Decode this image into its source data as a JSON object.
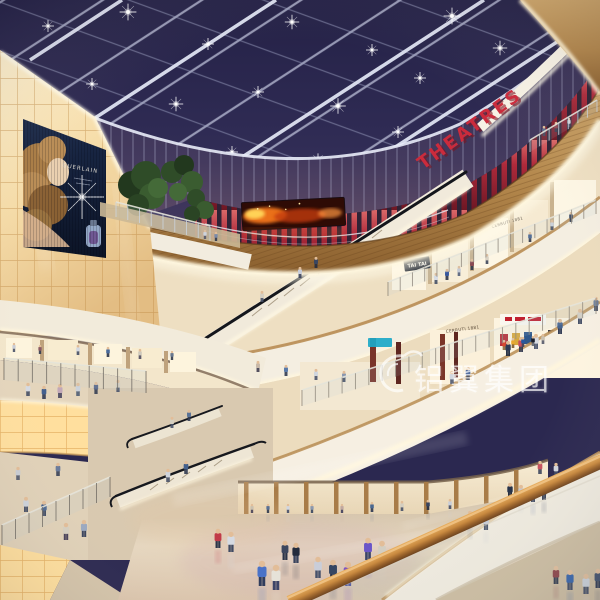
{
  "meta": {
    "description": "Architectural rendering of a multi-level shopping mall atrium at night with glass skylight"
  },
  "signs": {
    "theatres": "THEATRES",
    "cerruti_upper": "CERRUTI 1881",
    "cerruti_lower": "CERRUTI 1881",
    "tai_tai": "TAI TAI"
  },
  "billboard": {
    "brand": "GUERLAIN"
  },
  "watermark": {
    "text": "铝翼集团"
  },
  "palette": {
    "sky": "#2b2850",
    "sky_deep": "#1d1b3a",
    "beam": "#dfe3f2",
    "wood": "#b9894e",
    "wood_dark": "#8a5f2e",
    "fascia_white": "#f4ede0",
    "cove_glow": "#fff4d6",
    "sign_red": "#cb2b3c",
    "slat_red": "#a8293a",
    "wall_glow": "#f6dca8",
    "screen_fire": "#ff7b1e",
    "billboard_navy": "#16223e",
    "floor": "#d9c9b2",
    "rail_wood": "#c08547",
    "watermark_white": "#ffffff"
  },
  "scene": {
    "stars": [
      [
        48,
        26,
        1
      ],
      [
        128,
        12,
        1.4
      ],
      [
        208,
        44,
        1
      ],
      [
        292,
        22,
        1.2
      ],
      [
        372,
        50,
        1
      ],
      [
        452,
        16,
        1.4
      ],
      [
        540,
        10,
        1
      ],
      [
        92,
        84,
        1
      ],
      [
        176,
        104,
        1.2
      ],
      [
        258,
        92,
        1
      ],
      [
        338,
        106,
        1.3
      ],
      [
        420,
        78,
        1
      ],
      [
        500,
        48,
        1.2
      ],
      [
        146,
        148,
        0.9
      ],
      [
        232,
        152,
        1
      ],
      [
        318,
        160,
        1.1
      ],
      [
        398,
        132,
        1
      ],
      [
        64,
        142,
        0.9
      ],
      [
        560,
        96,
        1
      ],
      [
        582,
        60,
        1
      ]
    ],
    "people": [
      [
        544,
        136,
        10,
        "#5c6c8c",
        "#3a4258"
      ],
      [
        556,
        132,
        10,
        "#8c3c44",
        "#2e3448"
      ],
      [
        569,
        127,
        9,
        "#d8d8dc",
        "#4a5068"
      ],
      [
        300,
        278,
        11,
        "#c9cdd9",
        "#38415c"
      ],
      [
        316,
        268,
        11,
        "#3a4660",
        "#242c40"
      ],
      [
        262,
        302,
        11,
        "#d6d0c2",
        "#454f67"
      ],
      [
        205,
        239,
        9,
        "#d0d4dc",
        "#4a4a5a"
      ],
      [
        216,
        241,
        9,
        "#7a8aa8",
        "#323a4e"
      ],
      [
        436,
        284,
        11,
        "#d8dce4",
        "#434e66"
      ],
      [
        447,
        280,
        11,
        "#39589c",
        "#2a3146"
      ],
      [
        459,
        276,
        10,
        "#c5cad4",
        "#55607a"
      ],
      [
        472,
        270,
        11,
        "#8a4a52",
        "#2e3446"
      ],
      [
        487,
        264,
        10,
        "#d9d2c4",
        "#3c4458"
      ],
      [
        530,
        242,
        10,
        "#47628e",
        "#2c3246"
      ],
      [
        552,
        230,
        10,
        "#cdd2da",
        "#3e4a62"
      ],
      [
        571,
        222,
        10,
        "#32405c",
        "#232c40"
      ],
      [
        14,
        352,
        9,
        "#c8ccd6",
        "#4a5268"
      ],
      [
        40,
        354,
        9,
        "#8a5a62",
        "#343c50"
      ],
      [
        78,
        355,
        10,
        "#d4d8e0",
        "#444e66"
      ],
      [
        108,
        357,
        10,
        "#4a6a9a",
        "#2c3448"
      ],
      [
        140,
        359,
        10,
        "#cfc9bc",
        "#4e4a5e"
      ],
      [
        172,
        360,
        9,
        "#68788f",
        "#303a4e"
      ],
      [
        28,
        396,
        13,
        "#d6dae2",
        "#3e4860"
      ],
      [
        44,
        399,
        13,
        "#44608e",
        "#2c3650"
      ],
      [
        60,
        398,
        14,
        "#c2a8b8",
        "#42405a"
      ],
      [
        78,
        396,
        13,
        "#ccd2da",
        "#4a5a72"
      ],
      [
        96,
        394,
        12,
        "#5a6888",
        "#323c52"
      ],
      [
        118,
        392,
        12,
        "#d8d0c0",
        "#46506a"
      ],
      [
        258,
        372,
        11,
        "#c8b8a8",
        "#403c50"
      ],
      [
        286,
        376,
        11,
        "#5878a8",
        "#2e3850"
      ],
      [
        316,
        380,
        11,
        "#d0d6de",
        "#48526c"
      ],
      [
        344,
        382,
        11,
        "#8a98b0",
        "#3a445c"
      ],
      [
        452,
        384,
        13,
        "#d2d7df",
        "#454f69"
      ],
      [
        468,
        380,
        13,
        "#3c5a92",
        "#2b3348"
      ],
      [
        508,
        356,
        15,
        "#2e3a54",
        "#202a3e"
      ],
      [
        521,
        352,
        15,
        "#c74f5c",
        "#323a50"
      ],
      [
        536,
        349,
        15,
        "#d8dbe2",
        "#4a546e"
      ],
      [
        560,
        334,
        15,
        "#46648f",
        "#2d3650"
      ],
      [
        580,
        324,
        15,
        "#d5cfc2",
        "#3f4962"
      ],
      [
        596,
        311,
        14,
        "#6a7a96",
        "#333d55"
      ],
      [
        504,
        350,
        10,
        "#d84a30",
        "#8a6a3a"
      ],
      [
        513,
        348,
        10,
        "#e8a830",
        "#7a5a30"
      ],
      [
        523,
        347,
        10,
        "#2858a0",
        "#44485a"
      ],
      [
        533,
        346,
        10,
        "#1a1e2a",
        "#62666f"
      ],
      [
        543,
        344,
        10,
        "#c8c0b0",
        "#55596a"
      ],
      [
        168,
        482,
        13,
        "#cfd4dc",
        "#414b63"
      ],
      [
        186,
        474,
        13,
        "#44608c",
        "#2b354d"
      ],
      [
        172,
        428,
        11,
        "#d6d0c2",
        "#48526a"
      ],
      [
        189,
        421,
        11,
        "#5a7296",
        "#303a52"
      ],
      [
        26,
        512,
        15,
        "#cdd2da",
        "#424c64"
      ],
      [
        44,
        516,
        15,
        "#3f5c88",
        "#2a3450"
      ],
      [
        66,
        540,
        17,
        "#d6cfc0",
        "#463f58"
      ],
      [
        84,
        537,
        17,
        "#9aa8c0",
        "#38425c"
      ],
      [
        18,
        480,
        13,
        "#c8ccd4",
        "#485269"
      ],
      [
        58,
        476,
        13,
        "#6a7a9a",
        "#313b53"
      ],
      [
        252,
        513,
        9,
        "#cac0ae",
        "#4a4458"
      ],
      [
        268,
        513,
        9,
        "#5a7094",
        "#303a50"
      ],
      [
        288,
        513,
        9,
        "#d2d6de",
        "#47516b"
      ],
      [
        312,
        513,
        9,
        "#8a98ae",
        "#3a4860"
      ],
      [
        342,
        513,
        9,
        "#c0a8a0",
        "#42405c"
      ],
      [
        372,
        512,
        10,
        "#4a6890",
        "#2c3650"
      ],
      [
        402,
        511,
        10,
        "#d4cec0",
        "#475168"
      ],
      [
        428,
        510,
        10,
        "#36435f",
        "#232c42"
      ],
      [
        450,
        509,
        10,
        "#c9ced8",
        "#434d67"
      ],
      [
        218,
        548,
        19,
        "#c13a48",
        "#2c3448"
      ],
      [
        231,
        552,
        20,
        "#d6dae2",
        "#414b63"
      ],
      [
        262,
        586,
        25,
        "#4a72c8",
        "#303c5c"
      ],
      [
        276,
        590,
        25,
        "#e6e2d8",
        "#3c4468"
      ],
      [
        318,
        578,
        21,
        "#c9cdd9",
        "#47516b"
      ],
      [
        333,
        582,
        22,
        "#364662",
        "#263048"
      ],
      [
        348,
        586,
        24,
        "#8255bd",
        "#5057a0"
      ],
      [
        368,
        560,
        22,
        "#6a55c8",
        "#3a4468"
      ],
      [
        382,
        563,
        22,
        "#d3cec2",
        "#454f67"
      ],
      [
        296,
        563,
        20,
        "#232b3d",
        "#39435d"
      ],
      [
        285,
        560,
        19,
        "#3c465e",
        "#2a3348"
      ],
      [
        486,
        530,
        16,
        "#c8ccd6",
        "#434d65"
      ],
      [
        470,
        526,
        15,
        "#55688c",
        "#2f3951"
      ],
      [
        510,
        498,
        15,
        "#25324a",
        "#1c2436"
      ],
      [
        521,
        500,
        15,
        "#c3c9d3",
        "#404a62"
      ],
      [
        533,
        502,
        15,
        "#657ca4",
        "#323c56"
      ],
      [
        544,
        500,
        15,
        "#2f3a54",
        "#232d45"
      ],
      [
        540,
        474,
        13,
        "#c65360",
        "#353f57"
      ],
      [
        556,
        476,
        13,
        "#d1d5dd",
        "#444e66"
      ],
      [
        556,
        584,
        18,
        "#8a3a40",
        "#2b3347"
      ],
      [
        570,
        590,
        20,
        "#2f5ea8",
        "#3a445e"
      ],
      [
        586,
        594,
        20,
        "#ccd2da",
        "#414b63"
      ],
      [
        598,
        588,
        19,
        "#3c4a66",
        "#28324a"
      ]
    ]
  }
}
